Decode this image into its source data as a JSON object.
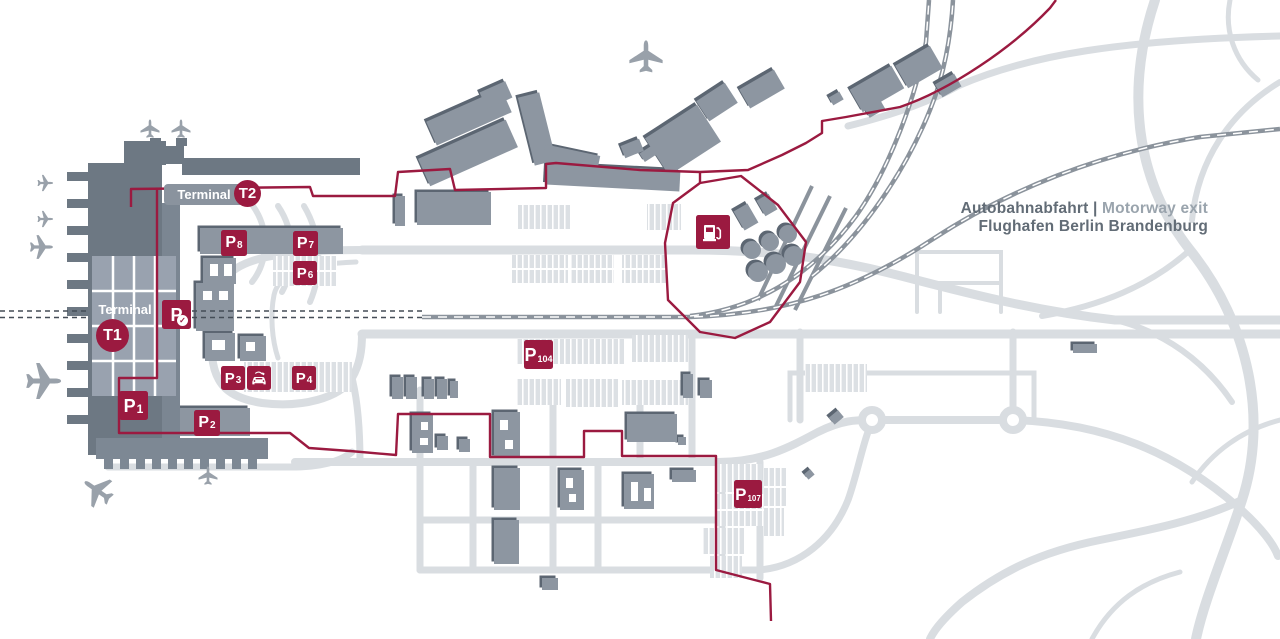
{
  "legend": {
    "line1_primary": "Autobahnabfahrt |",
    "line1_secondary": " Motorway exit",
    "line2": "Flughafen Berlin Brandenburg"
  },
  "terminals": {
    "t1": {
      "label": "Terminal",
      "badge": "T1"
    },
    "t2": {
      "label": "Terminal",
      "badge": "T2"
    }
  },
  "parking_badges": [
    {
      "id": "p8",
      "p": "P",
      "sub": "8",
      "x": 221,
      "y": 230,
      "size": 26
    },
    {
      "id": "p7",
      "p": "P",
      "sub": "7",
      "x": 293,
      "y": 231,
      "size": 25
    },
    {
      "id": "p6",
      "p": "P",
      "sub": "6",
      "x": 293,
      "y": 261,
      "size": 24
    },
    {
      "id": "p-check",
      "p": "P",
      "sub": "",
      "x": 162,
      "y": 300,
      "size": 29,
      "check": true
    },
    {
      "id": "p3",
      "p": "P",
      "sub": "3",
      "x": 221,
      "y": 366,
      "size": 24
    },
    {
      "id": "p4",
      "p": "P",
      "sub": "4",
      "x": 292,
      "y": 366,
      "size": 24
    },
    {
      "id": "p1",
      "p": "P",
      "sub": "1",
      "x": 119,
      "y": 391,
      "size": 29
    },
    {
      "id": "p2",
      "p": "P",
      "sub": "2",
      "x": 194,
      "y": 410,
      "size": 26
    },
    {
      "id": "p104",
      "p": "P",
      "sub": "104",
      "x": 524,
      "y": 340,
      "size": 29
    },
    {
      "id": "p107",
      "p": "P",
      "sub": "107",
      "x": 734,
      "y": 480,
      "size": 28
    }
  ],
  "icons": {
    "check_glyph": "✓",
    "fuel_station": {
      "x": 696,
      "y": 215,
      "size": 34
    },
    "e_charging": {
      "x": 247,
      "y": 366,
      "size": 24
    },
    "planes": [
      {
        "x": 150,
        "y": 129,
        "rot": 0,
        "scale": 1.0
      },
      {
        "x": 181,
        "y": 129,
        "rot": 0,
        "scale": 1.0
      },
      {
        "x": 45,
        "y": 183,
        "rot": 90,
        "scale": 0.85
      },
      {
        "x": 45,
        "y": 219,
        "rot": 90,
        "scale": 0.85
      },
      {
        "x": 41,
        "y": 247,
        "rot": 90,
        "scale": 1.25
      },
      {
        "x": 43,
        "y": 381,
        "rot": 90,
        "scale": 1.9
      },
      {
        "x": 98,
        "y": 491,
        "rot": -55,
        "scale": 1.7
      },
      {
        "x": 208,
        "y": 476,
        "rot": 0,
        "scale": 1.0
      },
      {
        "x": 646,
        "y": 57,
        "rot": 0,
        "scale": 1.75
      }
    ]
  },
  "colors": {
    "accent": "#9b1a40",
    "building": "#8d96a1",
    "building_shadow": "#5c6672",
    "terminal_building": "#6d7883",
    "road": "#d9dde1",
    "railway": "#8b939c",
    "parking_lot": "#dce0e4",
    "plane": "#99a1aa",
    "label_dark": "#626c76",
    "label_light": "#9aa4ad"
  }
}
